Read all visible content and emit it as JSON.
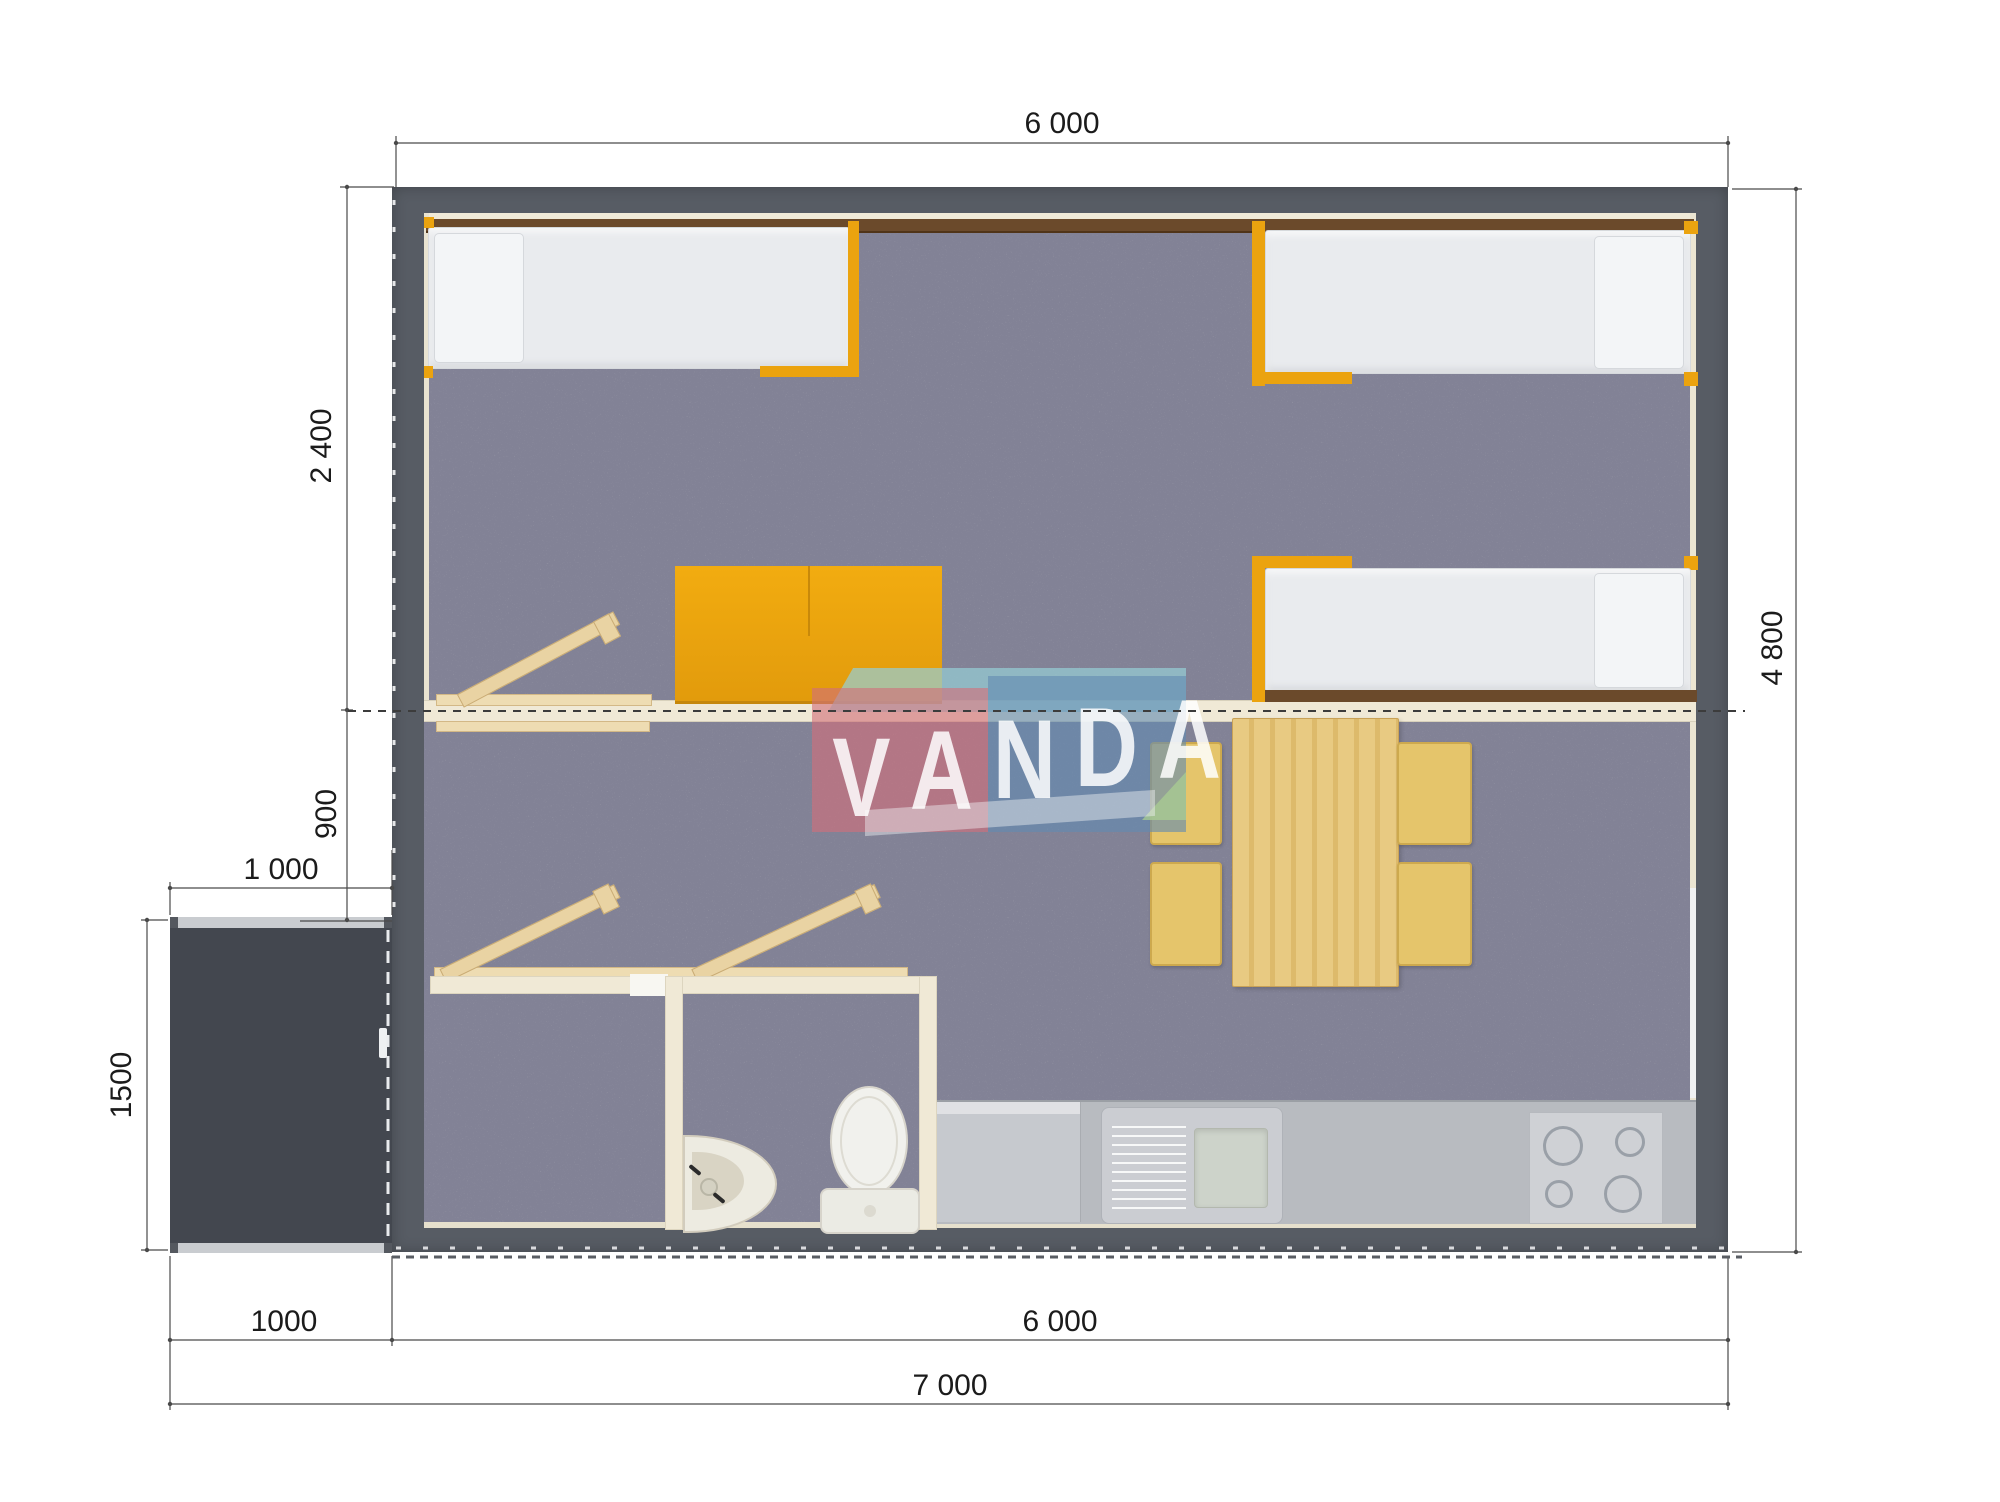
{
  "document": {
    "type": "architectural-floor-plan",
    "units": "mm"
  },
  "dimensions": {
    "top_width": "6 000",
    "bedroom_depth": "2 400",
    "hall_depth": "900",
    "porch_width_top": "1 000",
    "porch_depth": "1500",
    "side_height": "4 800",
    "bottom_porch_width": "1000",
    "bottom_main_width": "6 000",
    "bottom_total_width": "7 000"
  },
  "watermark": {
    "text": "VANDA",
    "letters": [
      "V",
      "A",
      "N",
      "D",
      "A"
    ],
    "pink": "#d2707a",
    "blue": "#628ab2",
    "cyan": "#96cdd4",
    "green": "#aacd91"
  },
  "colors": {
    "wall": "#575c64",
    "porch": "#43474f",
    "carpet": "#a8a8b0",
    "cream_wall": "#f0e9d6",
    "accent_orange": "#eba30f",
    "wood": "#e9d3a3",
    "table_wood": "#e3c173",
    "chair": "#e5c56b",
    "counter": "#b8bbc0",
    "mattress": "#e9ebee",
    "headboard_brown": "#6b4a2b",
    "dimension_line": "#4a4a4a"
  },
  "rooms": {
    "bedroom": {
      "beds": 3,
      "wardrobe": true,
      "benches": 1
    },
    "living": {
      "dining_table": true,
      "chairs": 4,
      "benches": 2
    },
    "bathroom": {
      "toilet": true,
      "washbasin": true
    },
    "kitchen": {
      "sink": true,
      "stove_burners": 4
    }
  }
}
